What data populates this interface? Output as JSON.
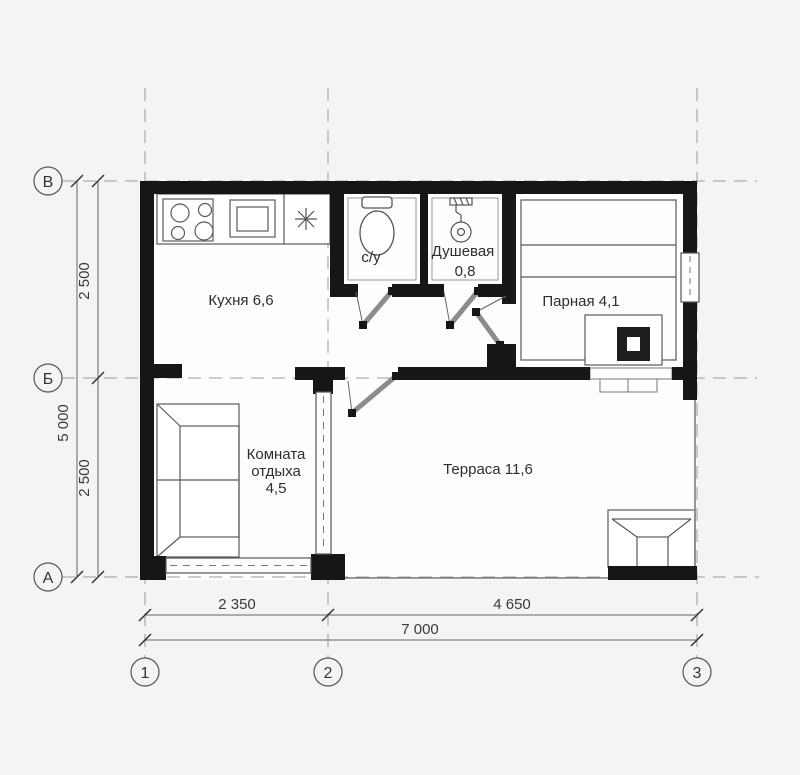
{
  "rooms": {
    "kitchen": "Кухня 6,6",
    "wc": "с/у",
    "shower_name": "Душевая",
    "shower_area": "0,8",
    "steam": "Парная 4,1",
    "rest_line1": "Комната",
    "rest_line2": "отдыха",
    "rest_line3": "4,5",
    "terrace": "Терраса 11,6"
  },
  "axes": {
    "row_top": "В",
    "row_mid": "Б",
    "row_bottom": "А",
    "col_left": "1",
    "col_mid": "2",
    "col_right": "3"
  },
  "dimensions": {
    "vertical_total": "5 000",
    "vertical_upper": "2 500",
    "vertical_lower": "2 500",
    "horizontal_left": "2 350",
    "horizontal_right": "4 650",
    "horizontal_total": "7 000"
  },
  "colors": {
    "wall": "#161616",
    "line": "#5a5a5a",
    "background": "#f5f4f2",
    "room_fill": "#fdfdfd"
  }
}
